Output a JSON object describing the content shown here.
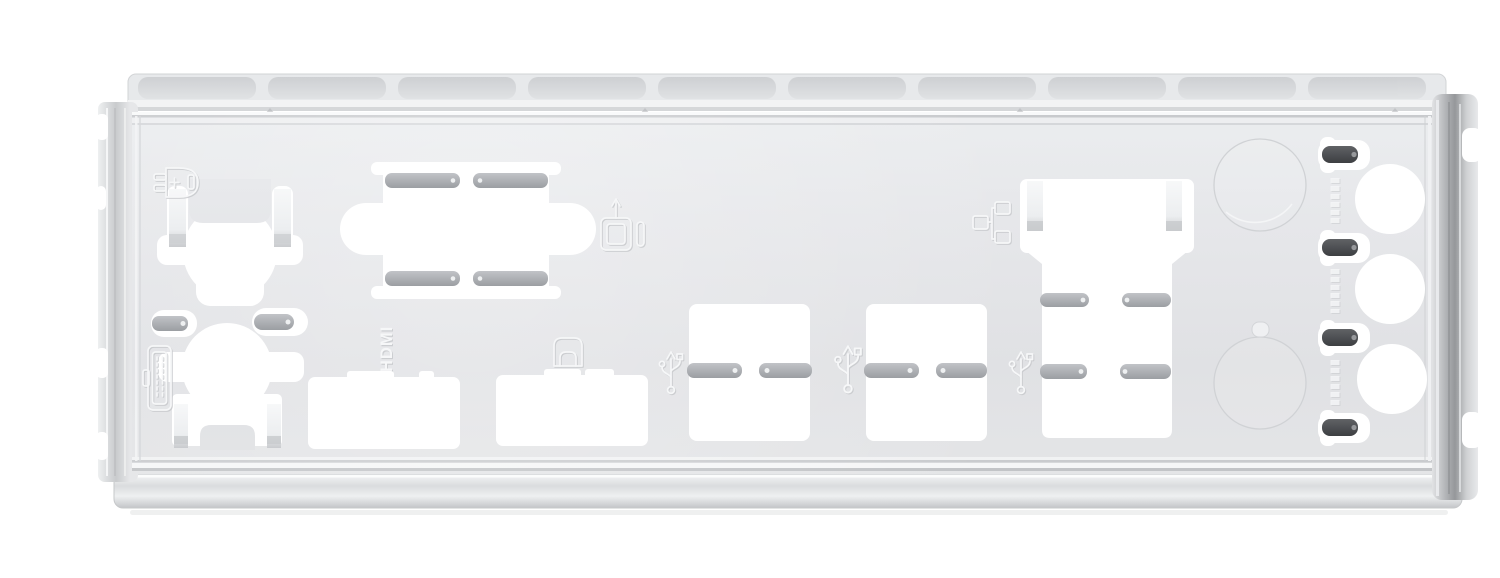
{
  "title": "Silver motherboard rear I/O shield backplate with punched port cutouts, photographed on a white background",
  "labels": {
    "hdmi": "HDMI"
  },
  "colors": {
    "background": "#ffffff",
    "plate": "#e4e5e8",
    "plate_highlight": "#eceef0",
    "cutout": "#ffffff",
    "finger": "#a9acb1",
    "finger_dark": "#4a4c4f",
    "bright_tab": "#f2f3f5",
    "flange_silver": "#b0b2b5",
    "emboss_light": "#f6f7f8",
    "emboss_shadow": "#c6c8cb",
    "knockout_outline": "#d0d2d5"
  },
  "icons": [
    "ps2-connector-icon",
    "pin-connector-icon",
    "usb-port-icon",
    "displayport-icon",
    "lan-icon",
    "usb-trident-icon",
    "usb-trident-icon",
    "usb-trident-icon"
  ],
  "cutouts": [
    "ps2-keyboard-cutout",
    "ps2-mouse-cutout",
    "grounding-slot-pair",
    "vga-dsub-cutout",
    "hdmi-cutout",
    "displayport-cutout",
    "usb-stack-cutout-1",
    "usb-stack-cutout-2",
    "lan-usb-stack-cutout",
    "knockout-circle-top",
    "knockout-circle-bottom",
    "audio-slot-1",
    "audio-slot-2",
    "audio-slot-3",
    "audio-slot-4",
    "audio-jack-1",
    "audio-jack-2",
    "audio-jack-3"
  ]
}
